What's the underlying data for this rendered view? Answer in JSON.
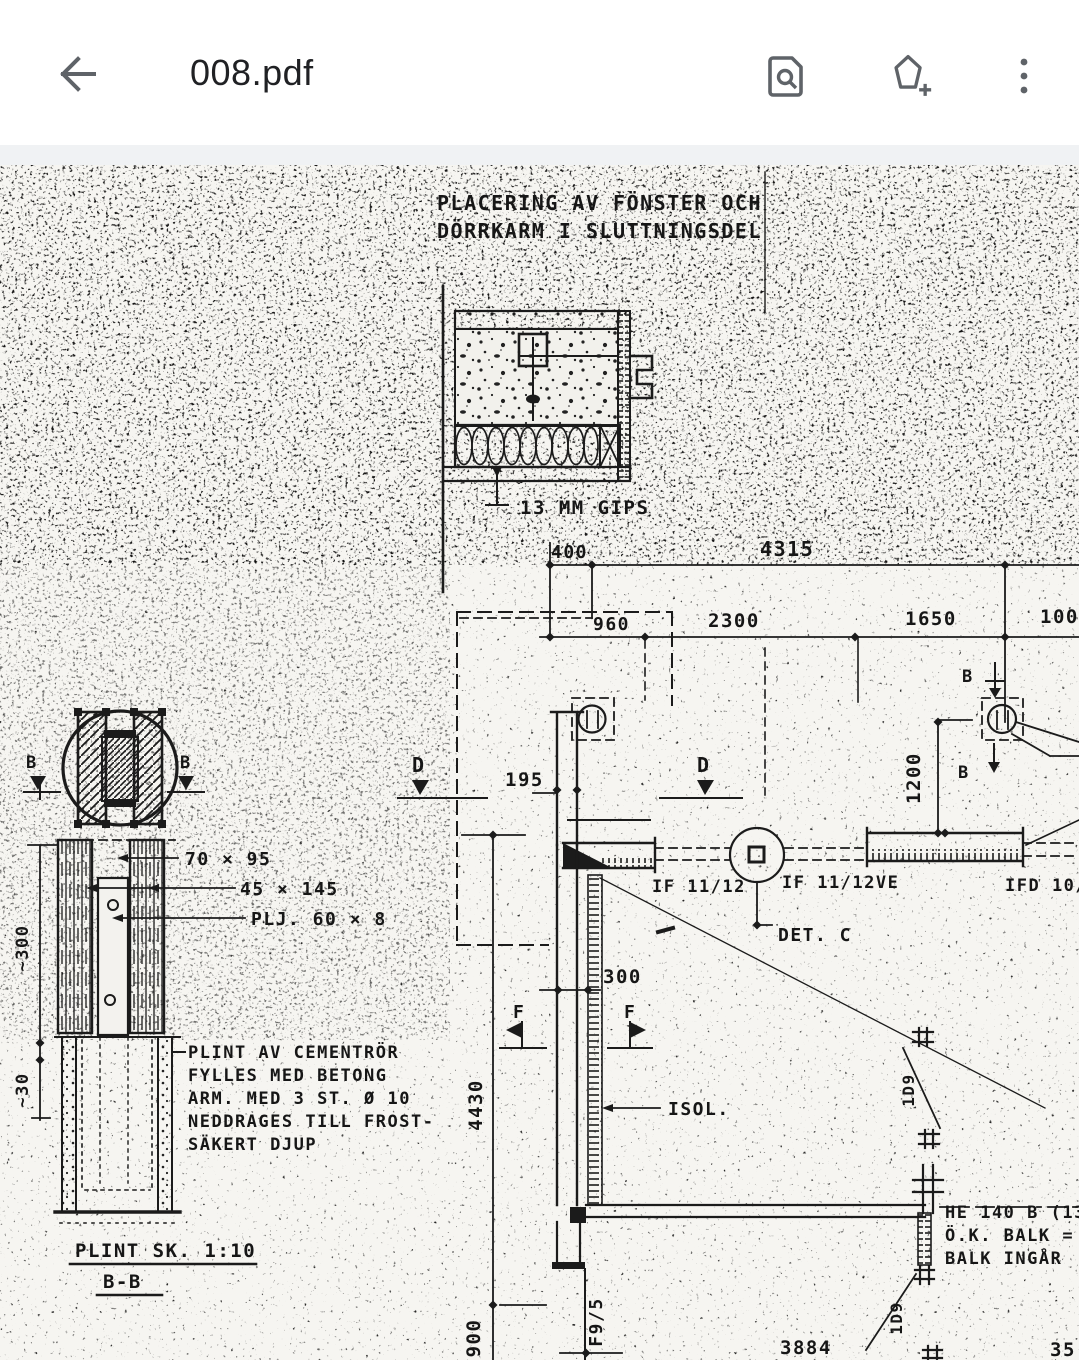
{
  "app_bar": {
    "title": "008.pdf",
    "icons": {
      "back": "back-arrow",
      "find": "find-in-page",
      "annotate": "add-annotation",
      "overflow": "more-options"
    }
  },
  "colors": {
    "ink": "#1b1b1b",
    "paper": "#f6f5f1",
    "icon_gray": "#5f6368",
    "title_text": "#202124"
  },
  "drawing": {
    "heading": [
      "PLACERING AV FÖNSTER OCH",
      "DÖRRKARM I SLUTTNINGSDEL"
    ],
    "labels": {
      "gips": "13 MM GIPS",
      "isol": "ISOL.",
      "det_c": "DET. C",
      "if_1": "IF 11/12",
      "if_2": "IF 11/12VE",
      "if_3": "IFD 10/2",
      "f95": "F9/5",
      "id9": "1D9",
      "dim_70": "70 × 95",
      "dim_45": "45 × 145",
      "plj": "PLJ. 60 × 8",
      "plint_title": "PLINT SK. 1:10",
      "section_bb": "B-B",
      "sec_b": "B",
      "sec_d": "D",
      "sec_f": "F"
    },
    "dims": {
      "d400": "400",
      "d4315": "4315",
      "d960": "960",
      "d2300": "2300",
      "d1650": "1650",
      "d1000": "1000",
      "d195": "195",
      "d1200": "1200",
      "d300": "300",
      "d4430": "4430",
      "d900": "900",
      "d3884": "3884",
      "d_partial": "35",
      "d_approx_300": "~300",
      "d_approx_30": "~30"
    },
    "plint_note": [
      "PLINT AV CEMENTRÖR",
      "FYLLES MED BETONG",
      "ARM. MED 3 ST. Ø 10",
      "NEDDRAGES TILL FROST-",
      "SÄKERT DJUP"
    ],
    "he_note": [
      "HE 140 B (13",
      "Ö.K. BALK = Ö.V",
      "BALK INGÅR"
    ]
  }
}
